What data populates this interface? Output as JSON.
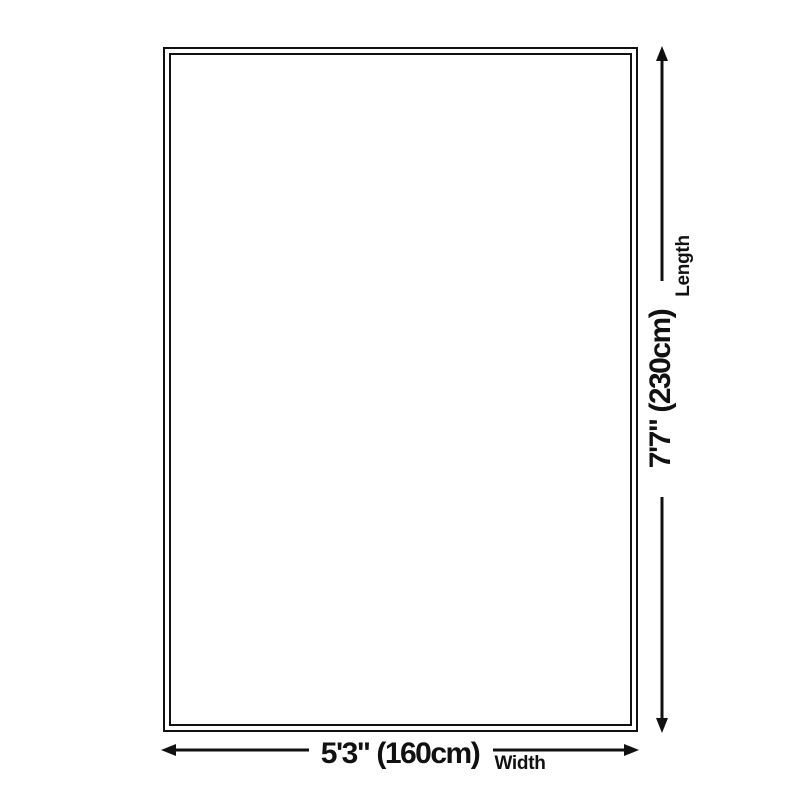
{
  "colors": {
    "foreground": "#111111",
    "background": "#ffffff"
  },
  "diagram": {
    "length": {
      "value": "7'7\" (230cm)",
      "label": "Length",
      "arrow_icons": [
        "arrow-up-icon",
        "arrow-down-icon"
      ]
    },
    "width": {
      "value": "5'3\" (160cm)",
      "label": "Width",
      "arrow_icons": [
        "arrow-left-icon",
        "arrow-right-icon"
      ]
    }
  }
}
